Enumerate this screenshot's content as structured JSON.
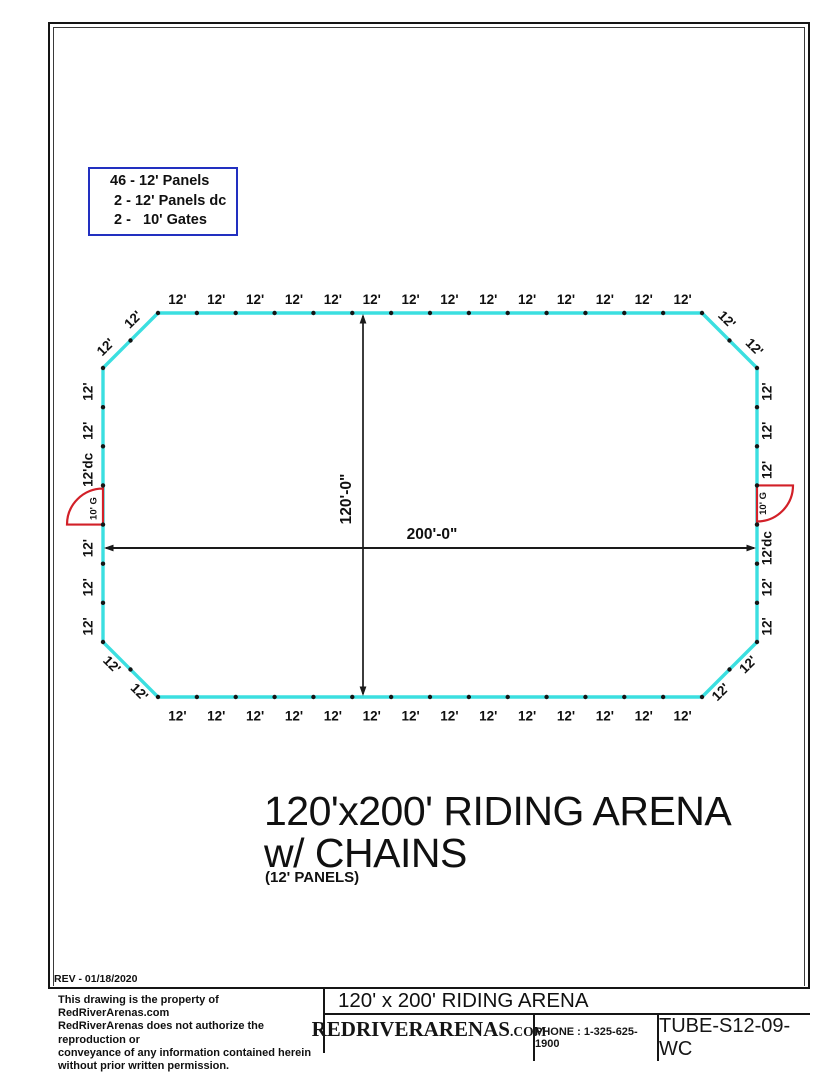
{
  "legend": {
    "items": [
      "46 - 12' Panels",
      " 2 - 12' Panels dc",
      " 2 -   10' Gates"
    ]
  },
  "diagram": {
    "colors": {
      "wall": "#3bdfe0",
      "gate": "#d22028",
      "line": "#1a1a1a",
      "text": "#101010"
    },
    "top_labels": [
      "12'",
      "12'",
      "12'",
      "12'",
      "12'",
      "12'",
      "12'",
      "12'",
      "12'",
      "12'",
      "12'",
      "12'",
      "12'",
      "12'"
    ],
    "bottom_labels": [
      "12'",
      "12'",
      "12'",
      "12'",
      "12'",
      "12'",
      "12'",
      "12'",
      "12'",
      "12'",
      "12'",
      "12'",
      "12'",
      "12'"
    ],
    "left_wall": [
      "12'",
      "12'",
      "12'dc",
      "10' G",
      "12'",
      "12'",
      "12'"
    ],
    "right_wall": [
      "12'",
      "12'",
      "12'",
      "10' G",
      "12'dc",
      "12'",
      "12'"
    ],
    "gate_label": "10' G",
    "corner_labels": {
      "top_left": [
        "12'",
        "12'"
      ],
      "top_right": [
        "12'",
        "12'"
      ],
      "bottom_right": [
        "12'",
        "12'"
      ],
      "bottom_left": [
        "12'",
        "12'"
      ]
    },
    "dim_width": "200'-0\"",
    "dim_height": "120'-0\""
  },
  "title": {
    "line1": "120'x200' RIDING ARENA",
    "line2": "w/ CHAINS",
    "line3": "(12' PANELS)"
  },
  "rev": "REV - 01/18/2020",
  "title_block": {
    "disclaimer": [
      "This drawing is the property of RedRiverArenas.com",
      "RedRiverArenas does not authorize the reproduction or",
      "conveyance of any information contained herein",
      "without prior written permission."
    ],
    "drawing_title": "120' x 200' RIDING ARENA",
    "brand": "REDRIVERARENAS",
    "brand_tld": ".COM",
    "phone": "PHONE : 1-325-625-1900",
    "part_number": "TUBE-S12-09-WC"
  }
}
